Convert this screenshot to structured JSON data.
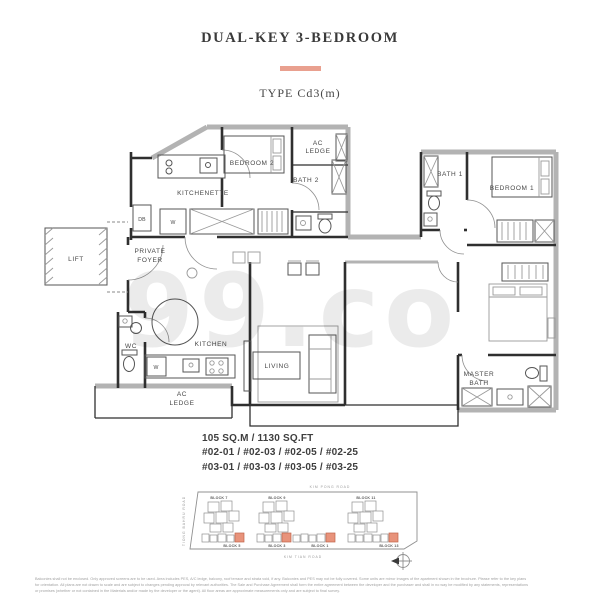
{
  "header": {
    "title": "DUAL-KEY 3-BEDROOM",
    "type_label": "TYPE Cd3(m)"
  },
  "watermark": "99.co",
  "floor_plan": {
    "labels": {
      "bedroom2": "BEDROOM 2",
      "ac_ledge_top_line1": "AC",
      "ac_ledge_top_line2": "LEDGE",
      "bath2": "BATH 2",
      "kitchenette": "KITCHENETTE",
      "washer1": "W",
      "db": "DB",
      "lift": "LIFT",
      "private_foyer_line1": "PRIVATE",
      "private_foyer_line2": "FOYER",
      "wc": "WC",
      "washer2": "W",
      "kitchen": "KITCHEN",
      "ac_ledge_bottom_line1": "AC",
      "ac_ledge_bottom_line2": "LEDGE",
      "living": "LIVING",
      "bath1": "BATH 1",
      "bedroom1": "BEDROOM 1",
      "master_bath_line1": "MASTER",
      "master_bath_line2": "BATH"
    }
  },
  "unit_info": {
    "area": "105 SQ.M / 1130 SQ.FT",
    "units_level2": "#02-01 / #02-03 / #02-05 / #02-25",
    "units_level3": "#03-01 / #03-03 / #03-05 / #03-25"
  },
  "site_plan": {
    "road_top": "KIM PONG ROAD",
    "road_bottom": "KIM TIAN ROAD",
    "road_left": "TIONG BAHRU ROAD",
    "blocks_top": [
      "BLOCK 7",
      "BLOCK 9",
      "BLOCK 11"
    ],
    "blocks_bottom": [
      "BLOCK 5",
      "BLOCK 3",
      "BLOCK 1",
      "BLOCK 13"
    ]
  },
  "disclaimer": {
    "line1": "Balconies shall not be enclosed. Only approved screens are to be used. Area includes PES, A/C ledge, balcony, roof terrace and strata void, if any. Balconies and PES may not be fully covered. Some units are mirror images of the apartment shown in the brochure. Please refer to the key plans",
    "line2": "for orientation. All plans are not drawn to scale and are subject to changes pending approval by relevant authorities. The Sale and Purchase Agreement shall form the entire agreement between the developer and the purchaser and shall in no way be modified by any statements, representations",
    "line3": "or promises (whether or not contained in the Materials and/or made by the developer or the agent). All floor areas are approximate measurements only and are subject to final survey."
  },
  "colors": {
    "accent_bar": "#E9A08F",
    "highlight_unit": "#E8937B",
    "wall": "#2F2F2F",
    "exterior_wall": "#B3B3B3"
  }
}
